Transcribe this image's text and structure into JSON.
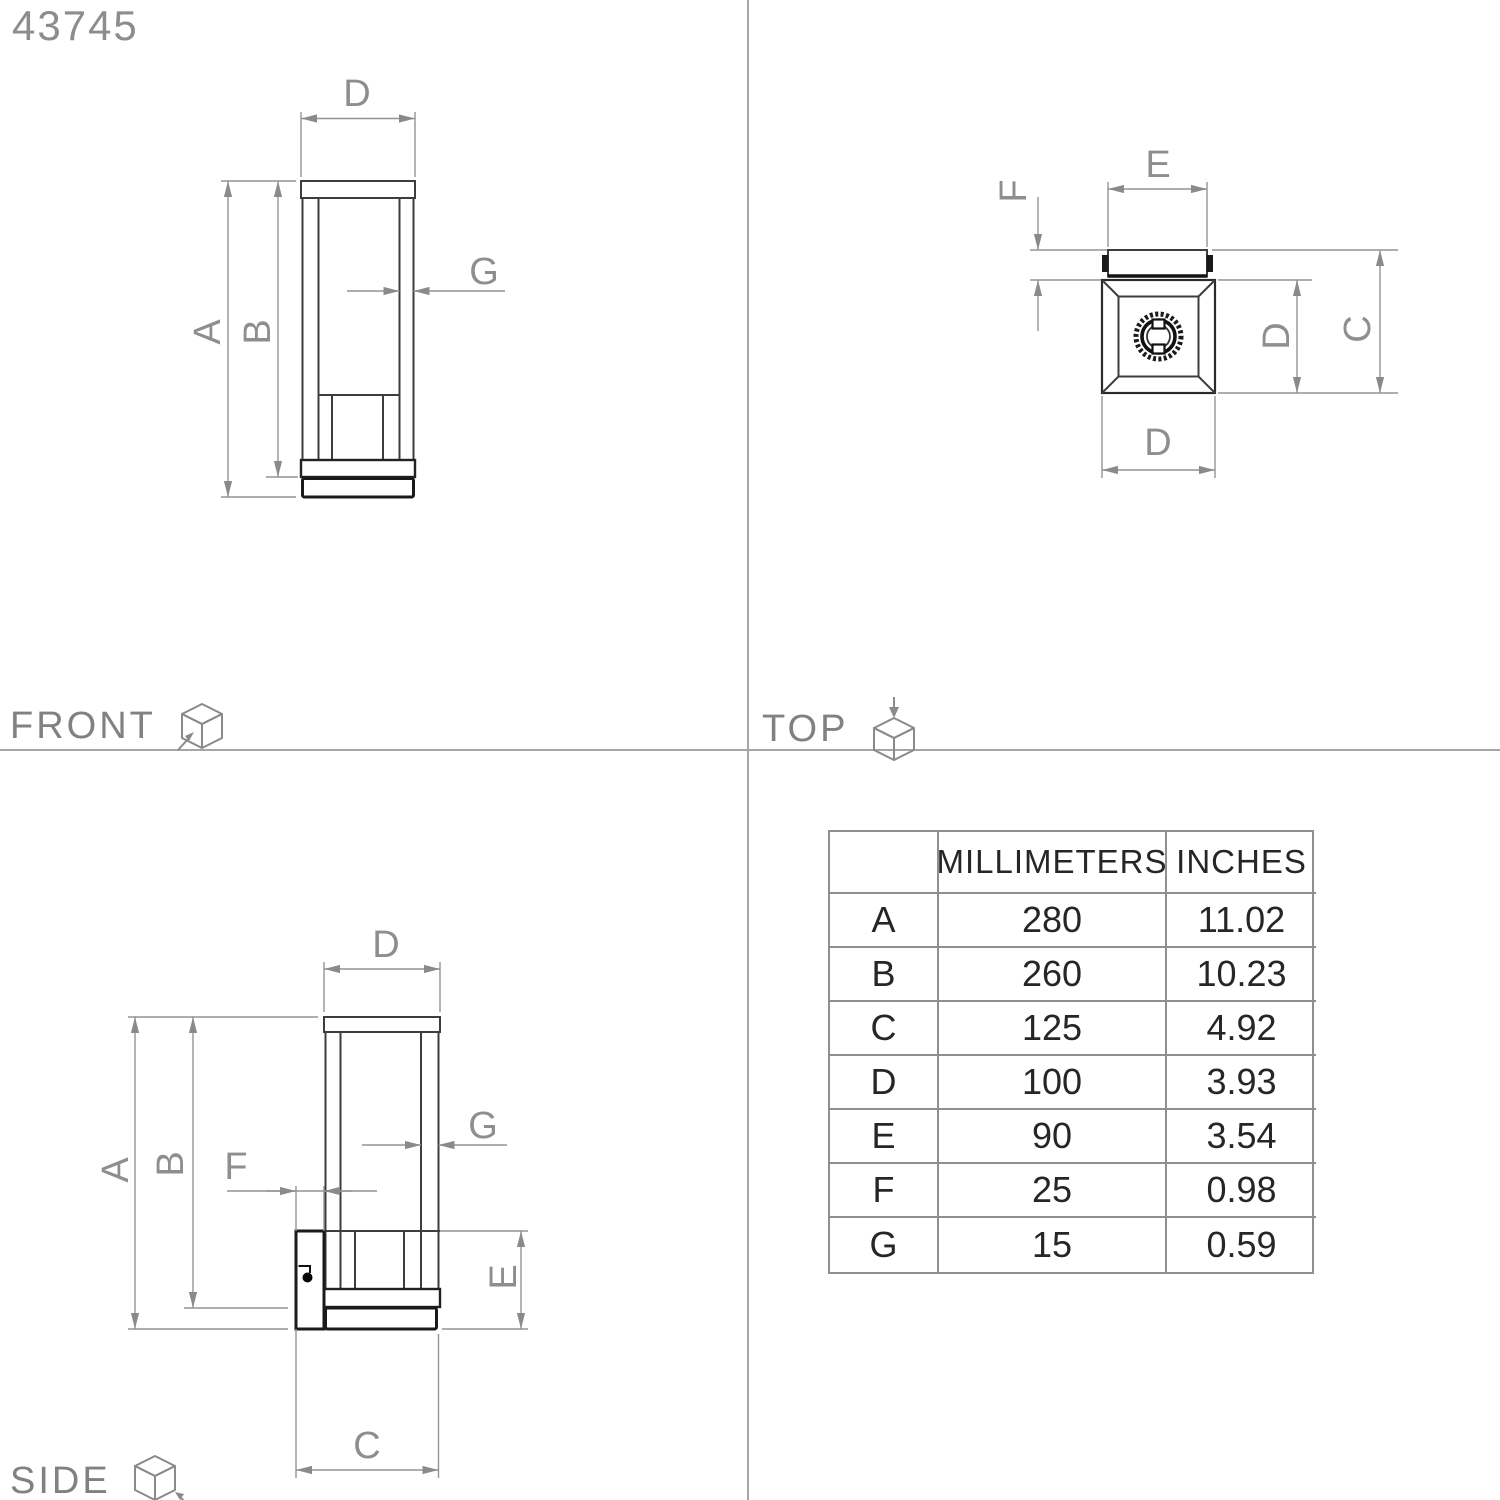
{
  "part_number": "43745",
  "views": {
    "front": {
      "label": "FRONT",
      "dim_d": "D",
      "dim_a": "A",
      "dim_b": "B",
      "dim_g": "G"
    },
    "top": {
      "label": "TOP",
      "dim_e": "E",
      "dim_f": "F",
      "dim_d_side": "D",
      "dim_c": "C",
      "dim_d_bottom": "D"
    },
    "side": {
      "label": "SIDE",
      "dim_d": "D",
      "dim_a": "A",
      "dim_b": "B",
      "dim_g": "G",
      "dim_f": "F",
      "dim_e": "E",
      "dim_c": "C"
    }
  },
  "icons": {
    "front": "cube-front-view-icon",
    "top": "cube-top-view-icon",
    "side": "cube-side-view-icon"
  },
  "table": {
    "headers": [
      "",
      "MILLIMETERS",
      "INCHES"
    ],
    "rows": [
      {
        "dim": "A",
        "mm": "280",
        "inches": "11.02"
      },
      {
        "dim": "B",
        "mm": "260",
        "inches": "10.23"
      },
      {
        "dim": "C",
        "mm": "125",
        "inches": "4.92"
      },
      {
        "dim": "D",
        "mm": "100",
        "inches": "3.93"
      },
      {
        "dim": "E",
        "mm": "90",
        "inches": "3.54"
      },
      {
        "dim": "F",
        "mm": "25",
        "inches": "0.98"
      },
      {
        "dim": "G",
        "mm": "15",
        "inches": "0.59"
      }
    ]
  },
  "colors": {
    "object_line": "#3d3d3d",
    "heavy_line": "#1a1a1a",
    "dimension_line": "#949494",
    "dimension_text": "#8e8e8e",
    "label_text": "#818181",
    "table_text": "#262626",
    "table_border": "#8f8f8f",
    "background": "#ffffff"
  }
}
